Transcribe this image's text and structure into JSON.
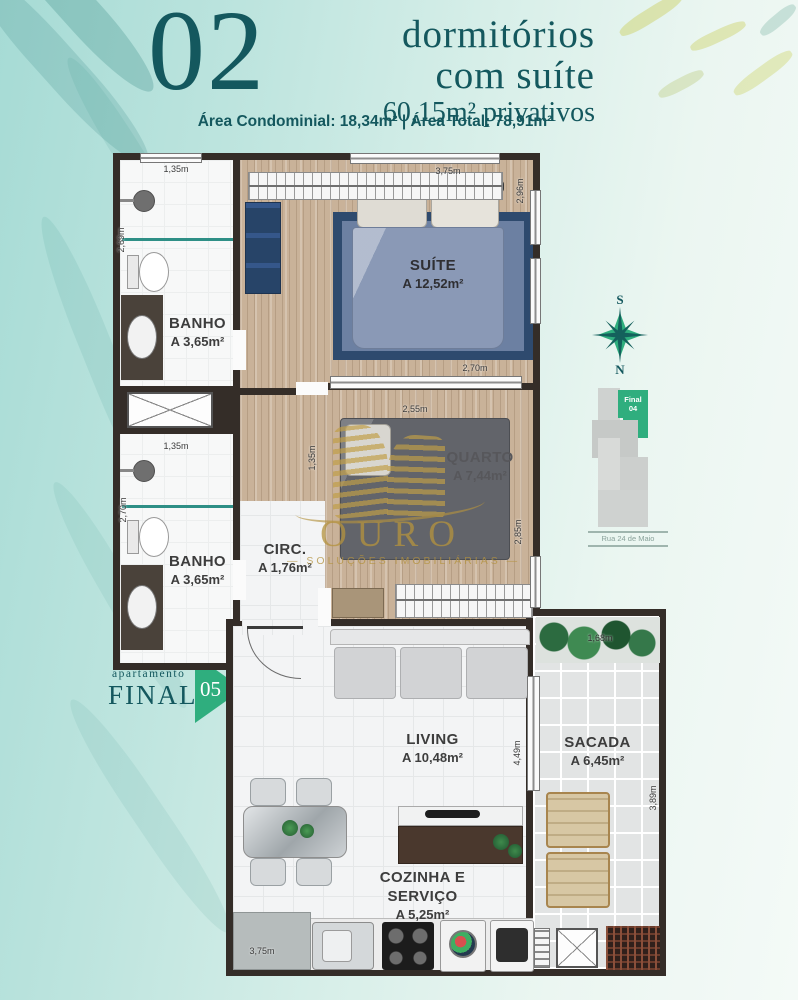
{
  "header": {
    "number": "02",
    "title_line1": "dormitórios",
    "title_line2": "com suíte",
    "subtitle": "60,15m² privativos",
    "areas_line": "Área Condominial: 18,34m² | Área Total: 78,91m²"
  },
  "rooms": [
    {
      "id": "banho-1",
      "label": "BANHO",
      "area": "A 3,65m²"
    },
    {
      "id": "suite",
      "label": "SUÍTE",
      "area": "A 12,52m²"
    },
    {
      "id": "banho-2",
      "label": "BANHO",
      "area": "A 3,65m²"
    },
    {
      "id": "circ",
      "label": "CIRC.",
      "area": "A 1,76m²"
    },
    {
      "id": "quarto",
      "label": "QUARTO",
      "area": "A 7,44m²"
    },
    {
      "id": "living",
      "label": "LIVING",
      "area": "A 10,48m²"
    },
    {
      "id": "sacada",
      "label": "SACADA",
      "area": "A 6,45m²"
    },
    {
      "id": "cozinha",
      "label_line1": "COZINHA E",
      "label_line2": "SERVIÇO",
      "area": "A 5,25m²"
    }
  ],
  "dims": {
    "banho1_top": "1,35m",
    "banho1_left": "2,69m",
    "banho2_top": "1,35m",
    "banho2_left": "2,70m",
    "suite_top": "3,75m",
    "suite_right": "2,96m",
    "suite_bottom": "2,70m",
    "quarto_top": "2,55m",
    "quarto_right": "2,85m",
    "circ_left": "1,35m",
    "living_right": "4,49m",
    "sacada_top": "1,68m",
    "sacada_right": "3,89m",
    "cozinha_bottom": "3,75m"
  },
  "compass": {
    "top": "S",
    "bottom": "N"
  },
  "key_plan": {
    "unit_line1": "Final",
    "unit_line2": "04",
    "street": "Rua 24 de Maio"
  },
  "apartment_tag": {
    "small": "apartamento",
    "big": "FINAL",
    "number": "05"
  },
  "watermark": {
    "brand": "OURO",
    "tagline": "— SOLUÇÕES IMOBILIÁRIAS —"
  },
  "colors": {
    "teal": "#14585e",
    "green": "#2fae7e",
    "gold": "#c2a050",
    "wall": "#342d28"
  }
}
